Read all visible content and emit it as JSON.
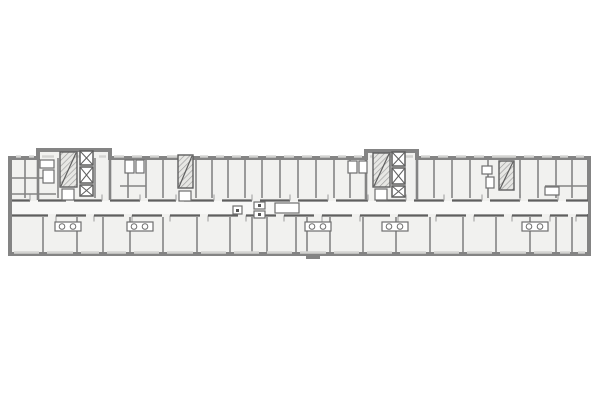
{
  "meta": {
    "kind": "architectural-floor-plan",
    "description": "long residential building floor plan, top view"
  },
  "colors": {
    "background": "#ffffff",
    "room_fill": "#f1f1ef",
    "corridor_fill": "#f8f8f7",
    "wall_dark": "#5f5f5f",
    "wall_main": "#848484",
    "wall_light": "#a9a9a9",
    "window_light": "#d3d3d1",
    "hatch_bg": "#e7e7e4",
    "hatch_line": "#9b9b9b",
    "fixture_stroke": "#6f6f6f",
    "fixture_fill": "#ffffff",
    "dot": "#555555"
  },
  "plan": {
    "outline": [
      [
        10,
        158
      ],
      [
        38,
        158
      ],
      [
        38,
        150
      ],
      [
        110,
        150
      ],
      [
        110,
        158
      ],
      [
        366,
        158
      ],
      [
        366,
        151
      ],
      [
        417,
        151
      ],
      [
        417,
        158
      ],
      [
        589,
        158
      ],
      [
        589,
        254
      ],
      [
        10,
        254
      ]
    ],
    "outline_stroke_w": 4,
    "corridor": {
      "x": 12,
      "y": 201,
      "w": 576,
      "h": 13
    },
    "corridor_walls": {
      "top": {
        "y": 200.5,
        "x1": 12,
        "x2": 588,
        "gap_w": 8,
        "gaps": [
          30,
          66,
          102,
          140,
          176,
          214,
          252,
          290,
          328,
          368,
          406,
          444,
          482,
          520,
          558
        ]
      },
      "bottom": {
        "y": 215.5,
        "x1": 12,
        "x2": 588,
        "gap_w": 8,
        "gaps": [
          48,
          86,
          124,
          162,
          200,
          238,
          276,
          314,
          352,
          390,
          428,
          466,
          504,
          542,
          568
        ]
      }
    },
    "core_walls": [
      {
        "x": 38,
        "y1": 150,
        "y2": 200
      },
      {
        "x": 110,
        "y1": 150,
        "y2": 200
      },
      {
        "x": 366,
        "y1": 151,
        "y2": 200
      },
      {
        "x": 417,
        "y1": 151,
        "y2": 200
      }
    ],
    "top_partitions": {
      "y1": 158,
      "y2": 198,
      "x": [
        25,
        58,
        95,
        128,
        146,
        163,
        196,
        212,
        228,
        245,
        262,
        280,
        298,
        316,
        334,
        350,
        434,
        452,
        470,
        488,
        520,
        538,
        556,
        572
      ]
    },
    "bottom_partitions": {
      "y1": 217,
      "y2": 252,
      "x": [
        43,
        77,
        103,
        130,
        163,
        197,
        230,
        252,
        267,
        296,
        307,
        330,
        363,
        396,
        430,
        463,
        496,
        530,
        556,
        572
      ]
    },
    "h_walls": [
      [
        10,
        178,
        48
      ],
      [
        10,
        194,
        56
      ],
      [
        120,
        186,
        146
      ],
      [
        545,
        186,
        588
      ]
    ],
    "windows_top": {
      "y": 156.5,
      "edges": [
        12,
        25,
        38,
        58,
        95,
        110,
        128,
        146,
        163,
        196,
        212,
        228,
        245,
        262,
        280,
        298,
        316,
        334,
        350,
        366,
        417,
        434,
        452,
        470,
        488,
        520,
        538,
        556,
        572,
        588
      ]
    },
    "windows_bottom": {
      "y": 252.5,
      "edges": [
        10,
        43,
        77,
        103,
        130,
        163,
        197,
        230,
        263,
        296,
        330,
        363,
        396,
        430,
        463,
        496,
        530,
        556,
        574,
        589
      ]
    },
    "stairs": [
      {
        "x": 60,
        "y": 152,
        "w": 17,
        "h": 35
      },
      {
        "x": 373,
        "y": 153,
        "w": 17,
        "h": 34
      },
      {
        "x": 178,
        "y": 155,
        "w": 15,
        "h": 33
      },
      {
        "x": 499,
        "y": 161,
        "w": 15,
        "h": 29
      }
    ],
    "elevators": [
      [
        80,
        151,
        13,
        14
      ],
      [
        80,
        167,
        13,
        16
      ],
      [
        80,
        185,
        13,
        11
      ],
      [
        392,
        152,
        13,
        14
      ],
      [
        392,
        168,
        13,
        16
      ],
      [
        392,
        186,
        13,
        11
      ]
    ],
    "fixtures": [
      [
        40,
        160,
        14,
        8
      ],
      [
        43,
        170,
        11,
        13
      ],
      [
        62,
        189,
        12,
        11
      ],
      [
        125,
        160,
        9,
        13
      ],
      [
        136,
        160,
        8,
        13
      ],
      [
        179,
        191,
        12,
        10
      ],
      [
        348,
        161,
        9,
        12
      ],
      [
        359,
        161,
        8,
        12
      ],
      [
        375,
        189,
        12,
        11
      ],
      [
        482,
        166,
        10,
        8
      ],
      [
        486,
        177,
        8,
        11
      ],
      [
        545,
        187,
        14,
        8
      ],
      [
        233,
        206,
        9,
        8
      ],
      [
        254,
        202,
        11,
        7
      ],
      [
        254,
        211,
        11,
        7
      ],
      [
        275,
        203,
        24,
        10
      ]
    ],
    "kitchens": {
      "centers": [
        68,
        140,
        318,
        395,
        535
      ],
      "y": 222,
      "w": 26,
      "h": 9,
      "circle_r": 2.8
    },
    "dots": [
      [
        236,
        209
      ],
      [
        258,
        204
      ],
      [
        258,
        213
      ]
    ],
    "entrance_step": [
      306,
      255,
      14,
      4
    ]
  }
}
